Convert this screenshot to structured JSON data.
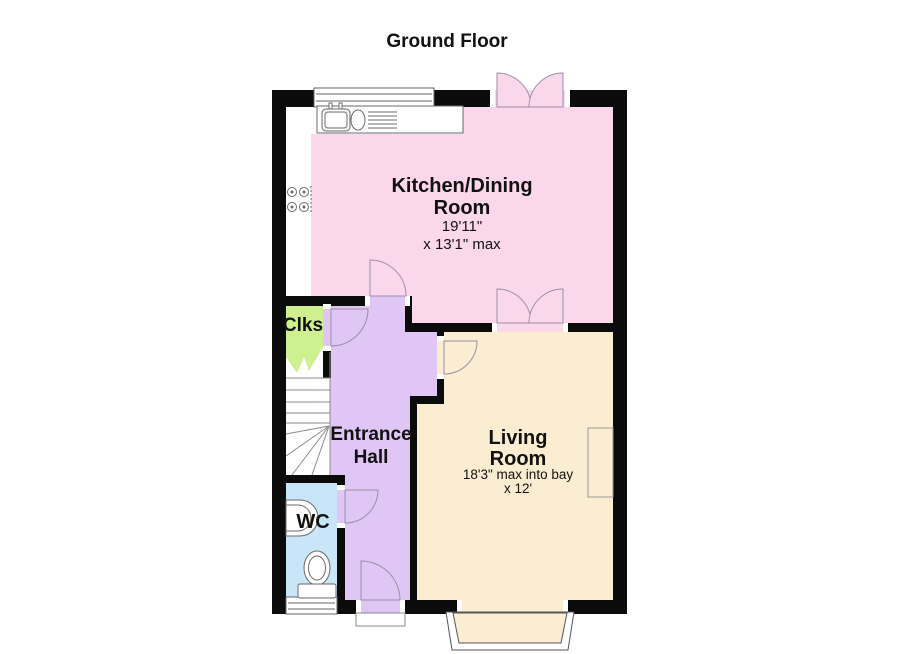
{
  "title": "Ground Floor",
  "colors": {
    "kitchen": "#FBD7EC",
    "living": "#FAEDD2",
    "hall": "#DFC6F4",
    "cloakroom": "#CEF08E",
    "wc": "#C9E6F8",
    "wall": "#0B0B0B",
    "white": "#FFFFFF"
  },
  "rooms": {
    "kitchen_dining": {
      "label_line1": "Kitchen/Dining",
      "label_line2": "Room",
      "dimensions_line1": "19'11\"",
      "dimensions_line2": "x 13'1\" max"
    },
    "living_room": {
      "label_line1": "Living",
      "label_line2": "Room",
      "dimensions_line1": "18'3\" max into bay",
      "dimensions_line2": "x 12'"
    },
    "entrance_hall": {
      "label_line1": "Entrance",
      "label_line2": "Hall"
    },
    "cloakroom": {
      "label": "Clks"
    },
    "wc": {
      "label": "WC"
    }
  },
  "icons": {
    "kitchen_sink": "sink-drainer-icon",
    "hob": "hob-icon",
    "wash_basin": "wash-basin-icon",
    "toilet": "toilet-icon",
    "staircase": "staircase-icon",
    "bay_window": "bay-window-icon",
    "fireplace": "chimney-breast-icon",
    "porch": "door-step-icon"
  }
}
